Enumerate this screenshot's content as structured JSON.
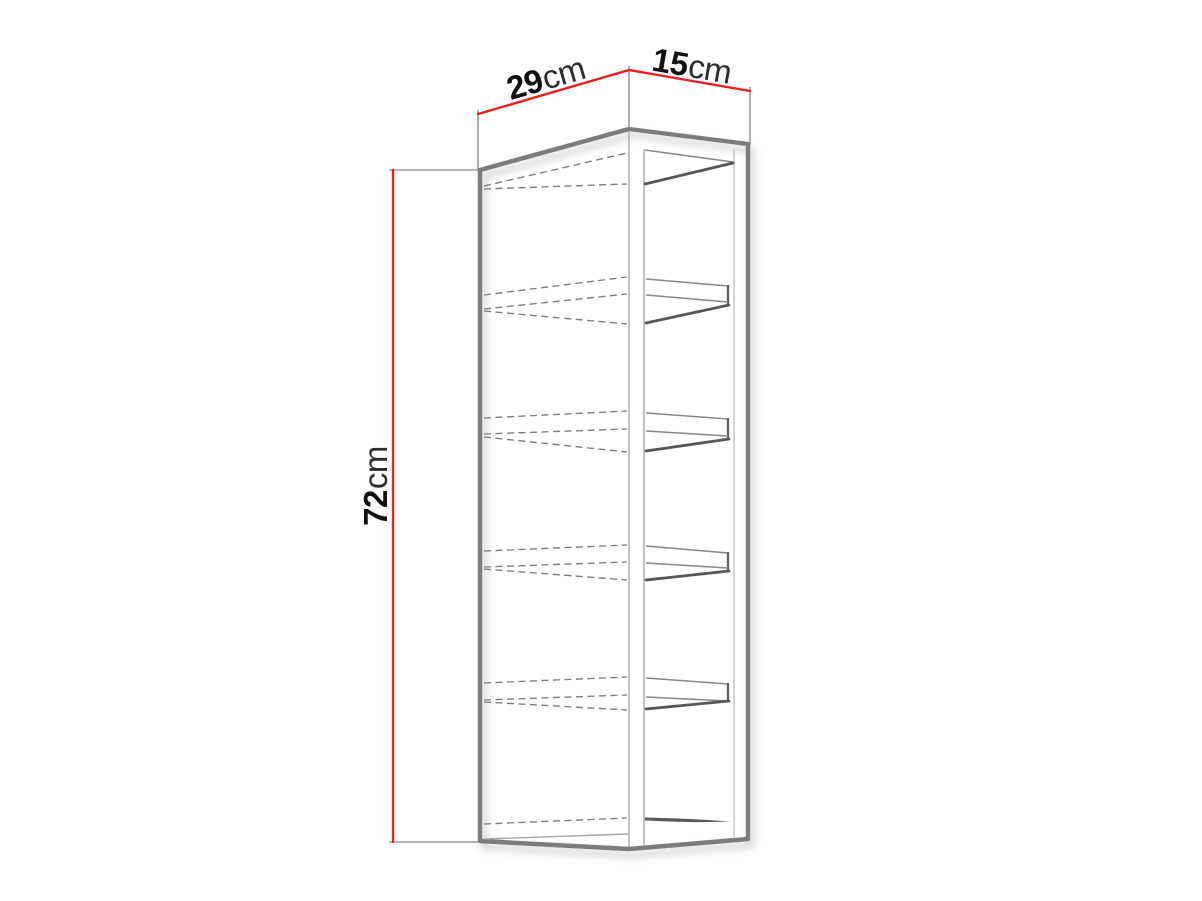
{
  "diagram": {
    "subject": "wall-cabinet-dimension-drawing",
    "dimensions": {
      "depth": {
        "value": "29",
        "unit": "cm"
      },
      "width": {
        "value": "15",
        "unit": "cm"
      },
      "height": {
        "value": "72",
        "unit": "cm"
      }
    },
    "shelf_count": 4,
    "colors": {
      "background": "#ffffff",
      "dimension_line": "#ee1c1c",
      "cabinet_outline": "#7c7c7c",
      "inner_edge": "#a5a5a5",
      "hidden_edge_dashed": "#7a7a7a",
      "value_text": "#111111",
      "unit_text": "#2b2b2b"
    }
  }
}
